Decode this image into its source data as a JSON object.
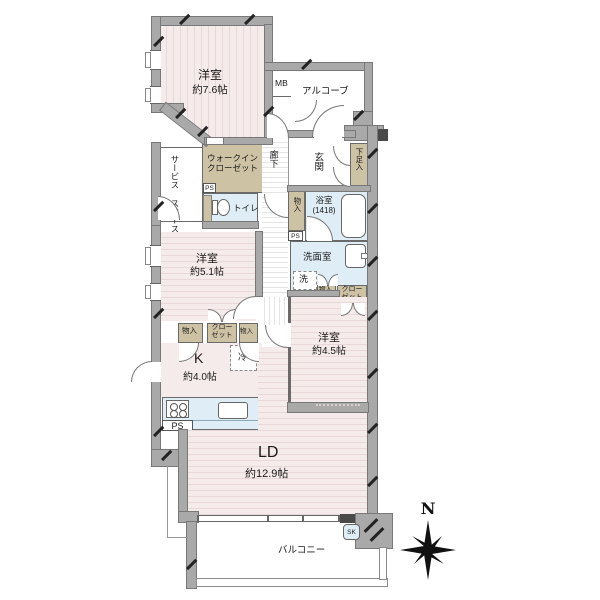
{
  "labels": {
    "r76_name": "洋室",
    "r76_size": "約7.6帖",
    "r51_name": "洋室",
    "r51_size": "約5.1帖",
    "r45_name": "洋室",
    "r45_size": "約4.5帖",
    "ld_name": "LD",
    "ld_size": "約12.9帖",
    "k_name": "K",
    "k_size": "約4.0帖",
    "wic_l1": "ウォークイン",
    "wic_l2": "クローゼット",
    "service_l1": "サービス",
    "service_l2": "スペース",
    "rouka": "廊下",
    "genkan": "玄関",
    "geta": "下足入",
    "alcove": "アルコーブ",
    "mb": "MB",
    "toilet": "トイレ",
    "bath_name": "浴室",
    "bath_size": "(1418)",
    "senmen": "洗面室",
    "sen": "洗",
    "monoire": "物入",
    "closet_l1": "クロー",
    "closet_l2": "ゼット",
    "rei": "冷",
    "ps": "PS",
    "sk": "SK",
    "balcony": "バルコニー",
    "north": "N"
  },
  "colors": {
    "wall_gray": "#a9a9a9",
    "wall_dark": "#4a4a4a",
    "room_pink": "#f6ebeb",
    "stripe_pink": "#e8d8d8",
    "closet_beige": "#cec2a5",
    "wet_area_blue": "#dfeef6",
    "hallway_stripe": "#e4e4e4",
    "outline": "#666666"
  }
}
